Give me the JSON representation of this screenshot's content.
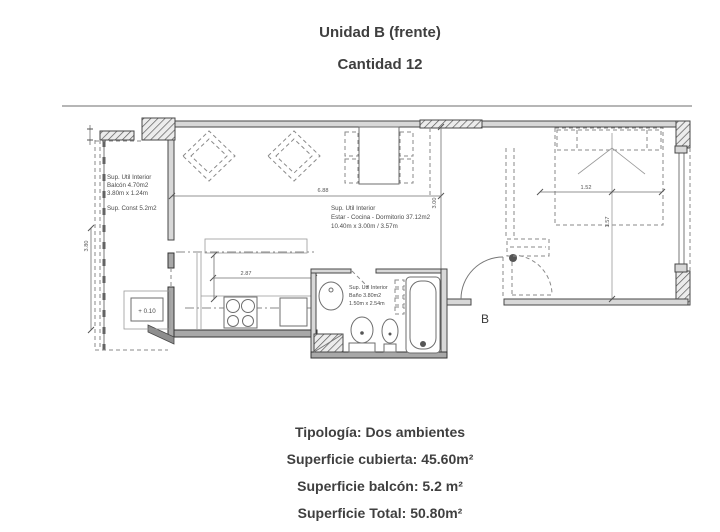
{
  "title": "Unidad B (frente)",
  "subtitle": "Cantidad 12",
  "colors": {
    "ink": "#3f3f3f",
    "wall_fill": "#d8d8d8",
    "background": "#ffffff"
  },
  "plan": {
    "balcony_label": {
      "line1": "Sup. Util Interior",
      "line2": "Balcón 4.70m2",
      "line3": "3.80m x 1.24m",
      "line4": "Sup. Const 5.2m2"
    },
    "main_label": {
      "line1": "Sup. Util Interior",
      "line2": "Estar - Cocina - Dormitorio 37.12m2",
      "line3": "10.40m x 3.00m / 3.57m"
    },
    "bath_label": {
      "line1": "Sup. Util Interior",
      "line2": "Baño 3.80m2",
      "line3": "1.50m x 2.54m"
    },
    "level_label": "+ 0.10",
    "unit_label": "B",
    "dims": {
      "living_width": "6.88",
      "living_height": "3.00",
      "kitchen_width": "2.87",
      "bed_width": "1.52",
      "bed_length": "1.57",
      "balcony_length": "3.80"
    }
  },
  "footer": {
    "tipologia": "Tipología: Dos ambientes",
    "cubierta": "Superficie cubierta: 45.60m²",
    "balcon": "Superficie balcón: 5.2 m²",
    "total": "Superficie Total: 50.80m²"
  }
}
